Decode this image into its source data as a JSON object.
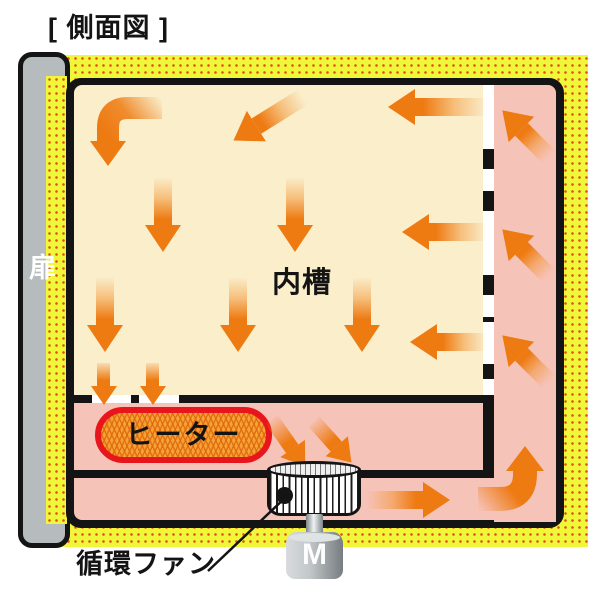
{
  "title": "[ 側面図 ]",
  "diagram": {
    "subject": "circulation-oven-side-view",
    "labels": {
      "door": "扉",
      "inner_chamber": "内槽",
      "heater": "ヒーター",
      "fan": "循環ファン",
      "motor": "M"
    },
    "colors": {
      "insulation_yellow": "#f0f63a",
      "insulation_dot": "#e34b10",
      "chamber_cream": "#faeecb",
      "duct_pink": "#f6c3b9",
      "arrow_orange": "#ee7a12",
      "heater_fill": "#f6a332",
      "heater_border": "#e9151c",
      "door_gray": "#b6bbbe",
      "outline_black": "#141414"
    },
    "airflow_arrows": [
      {
        "area": "inner_chamber_top_left",
        "direction": "left-then-down-curved"
      },
      {
        "area": "inner_chamber_top",
        "direction": "down-left-diagonal"
      },
      {
        "area": "inner_chamber_right_row1",
        "direction": "left-through-perforated-wall"
      },
      {
        "area": "inner_chamber_right_row2",
        "direction": "left-through-perforated-wall"
      },
      {
        "area": "inner_chamber_right_row3",
        "direction": "left-through-perforated-wall"
      },
      {
        "area": "inner_chamber_mid_row",
        "direction": "down"
      },
      {
        "area": "inner_chamber_mid_row",
        "direction": "down"
      },
      {
        "area": "inner_chamber_lower_row",
        "direction": "down"
      },
      {
        "area": "inner_chamber_lower_row",
        "direction": "down"
      },
      {
        "area": "inner_chamber_lower_row",
        "direction": "down"
      },
      {
        "area": "chamber_floor_outlet",
        "direction": "down-small"
      },
      {
        "area": "chamber_floor_outlet",
        "direction": "down-small"
      },
      {
        "area": "heater_duct_to_fan",
        "direction": "down-right-diagonal"
      },
      {
        "area": "heater_duct_to_fan",
        "direction": "down-right-diagonal"
      },
      {
        "area": "bottom_duct_from_fan",
        "direction": "right"
      },
      {
        "area": "bottom_right_corner",
        "direction": "right-then-up-curved"
      },
      {
        "area": "right_duct",
        "direction": "up-left-diagonal"
      },
      {
        "area": "right_duct",
        "direction": "up-left-diagonal"
      },
      {
        "area": "right_duct",
        "direction": "up-left-diagonal"
      }
    ]
  }
}
